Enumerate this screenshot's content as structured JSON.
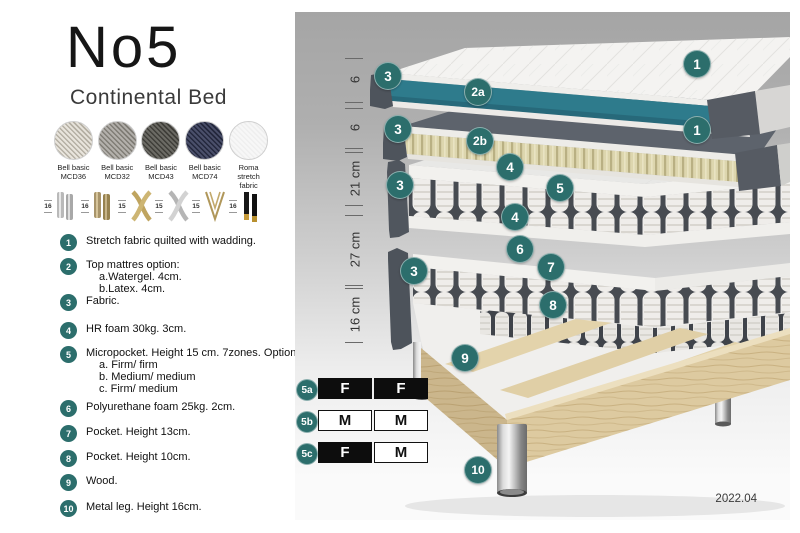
{
  "title": "No5",
  "subtitle": "Continental Bed",
  "fabrics": [
    {
      "name": "Bell basic",
      "code": "MCD36",
      "color1": "#e8e4dc",
      "color2": "#b5b0a4"
    },
    {
      "name": "Bell basic",
      "code": "MCD32",
      "color1": "#b3b0ab",
      "color2": "#807d76"
    },
    {
      "name": "Bell basic",
      "code": "MCD43",
      "color1": "#6b6a64",
      "color2": "#3f3e39"
    },
    {
      "name": "Bell basic",
      "code": "MCD74",
      "color1": "#4a4f6a",
      "color2": "#23273c"
    },
    {
      "name": "Roma",
      "code": "stretch fabric",
      "color1": "#f7f7f7",
      "color2": "#efefef"
    }
  ],
  "leg_options": [
    {
      "height": "16",
      "style": "cylinder-silver"
    },
    {
      "height": "16",
      "style": "cylinder-brass"
    },
    {
      "height": "15",
      "style": "cross-gold"
    },
    {
      "height": "15",
      "style": "cross-silver"
    },
    {
      "height": "15",
      "style": "hairpin-gold"
    },
    {
      "height": "16",
      "style": "stick-black-gold"
    }
  ],
  "parts": [
    {
      "num": "1",
      "text": "Stretch fabric quilted with wadding.",
      "sub": []
    },
    {
      "num": "2",
      "text": "Top mattres option:",
      "sub": [
        "a.Watergel. 4cm.",
        "b.Latex. 4cm."
      ]
    },
    {
      "num": "3",
      "text": "Fabric.",
      "sub": []
    },
    {
      "num": "4",
      "text": "HR foam 30kg. 3cm.",
      "sub": []
    },
    {
      "num": "5",
      "text": "Micropocket. Height 15 cm. 7zones. Option:",
      "sub": [
        "a. Firm/ firm",
        "b. Medium/ medium",
        "c. Firm/ medium"
      ]
    },
    {
      "num": "6",
      "text": "Polyurethane foam 25kg. 2cm.",
      "sub": []
    },
    {
      "num": "7",
      "text": "Pocket. Height 13cm.",
      "sub": []
    },
    {
      "num": "8",
      "text": "Pocket. Height 10cm.",
      "sub": []
    },
    {
      "num": "9",
      "text": "Wood.",
      "sub": []
    },
    {
      "num": "10",
      "text": "Metal leg. Height 16cm.",
      "sub": []
    }
  ],
  "diagram": {
    "dimensions": [
      {
        "label": "6",
        "top": 46,
        "bottom": 90
      },
      {
        "label": "6",
        "top": 96,
        "bottom": 136
      },
      {
        "label": "21 cm",
        "top": 140,
        "bottom": 193
      },
      {
        "label": "27 cm",
        "top": 203,
        "bottom": 273
      },
      {
        "label": "16 cm",
        "top": 276,
        "bottom": 330
      }
    ],
    "callouts": [
      {
        "label": "3",
        "x": 93,
        "y": 64
      },
      {
        "label": "2a",
        "x": 183,
        "y": 80
      },
      {
        "label": "1",
        "x": 402,
        "y": 52
      },
      {
        "label": "3",
        "x": 103,
        "y": 117
      },
      {
        "label": "2b",
        "x": 185,
        "y": 129
      },
      {
        "label": "1",
        "x": 402,
        "y": 118
      },
      {
        "label": "4",
        "x": 215,
        "y": 155
      },
      {
        "label": "3",
        "x": 105,
        "y": 173
      },
      {
        "label": "5",
        "x": 265,
        "y": 176
      },
      {
        "label": "4",
        "x": 220,
        "y": 205
      },
      {
        "label": "6",
        "x": 225,
        "y": 237
      },
      {
        "label": "7",
        "x": 256,
        "y": 255
      },
      {
        "label": "3",
        "x": 119,
        "y": 259
      },
      {
        "label": "8",
        "x": 258,
        "y": 293
      },
      {
        "label": "9",
        "x": 170,
        "y": 346
      },
      {
        "label": "10",
        "x": 183,
        "y": 458
      }
    ],
    "firmness": [
      {
        "label": "5a",
        "cells": [
          {
            "text": "F",
            "dark": true
          },
          {
            "text": "F",
            "dark": true
          }
        ]
      },
      {
        "label": "5b",
        "cells": [
          {
            "text": "M",
            "dark": false
          },
          {
            "text": "M",
            "dark": false
          }
        ]
      },
      {
        "label": "5c",
        "cells": [
          {
            "text": "F",
            "dark": true
          },
          {
            "text": "M",
            "dark": false
          }
        ]
      }
    ],
    "version": "2022.04"
  },
  "colors": {
    "accent": "#2C6E6C",
    "watergel": "#2E7B8C",
    "fabric_dark": "#4E545C",
    "wood": "#DDCAA0"
  }
}
